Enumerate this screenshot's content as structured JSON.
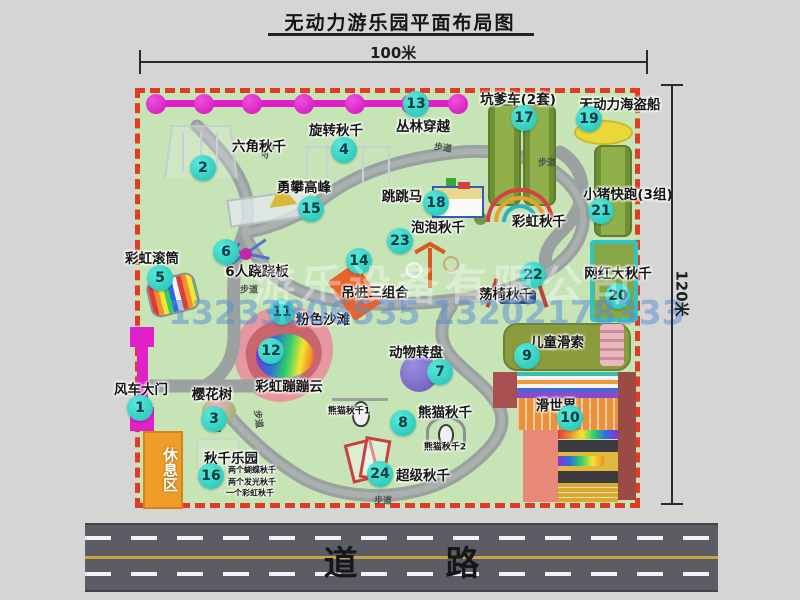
{
  "title": "无动力游乐园平面布局图",
  "dimensions": {
    "top": "100米",
    "right": "120米"
  },
  "road_label": "道 路",
  "rest_area_label": "休息区",
  "walkway_label": "步道",
  "watermark": {
    "company": "游乐设备有限公司",
    "phones": "13233806535 13202178333"
  },
  "colors": {
    "map_green": "#c6e4b5",
    "border_red": "#e23b25",
    "badge_teal": "#1fc2b3",
    "chain_magenta": "#e31ccb",
    "gate_magenta": "#e020c8",
    "rest_orange": "#f09c28",
    "road_gray": "#5c5c64",
    "walkway_gray": "#9ba1a0"
  },
  "attractions": [
    {
      "id": 1,
      "name": "风车大门",
      "badge": [
        140,
        408
      ],
      "label": [
        141,
        388
      ]
    },
    {
      "id": 2,
      "name": "六角秋千",
      "badge": [
        203,
        168
      ],
      "label": [
        259,
        145
      ]
    },
    {
      "id": 3,
      "name": "樱花树",
      "badge": [
        214,
        419
      ],
      "label": [
        212,
        393
      ]
    },
    {
      "id": 4,
      "name": "旋转秋千",
      "badge": [
        344,
        150
      ],
      "label": [
        336,
        129
      ]
    },
    {
      "id": 5,
      "name": "彩虹滚筒",
      "badge": [
        160,
        278
      ],
      "label": [
        152,
        257
      ]
    },
    {
      "id": 6,
      "name": "6人跷跷板",
      "badge": [
        226,
        252
      ],
      "label": [
        257,
        270
      ]
    },
    {
      "id": 7,
      "name": "动物转盘",
      "badge": [
        440,
        372
      ],
      "label": [
        416,
        351
      ]
    },
    {
      "id": 8,
      "name": "熊猫秋千",
      "badge": [
        403,
        423
      ],
      "label": [
        445,
        411
      ]
    },
    {
      "id": 9,
      "name": "儿童滑索",
      "badge": [
        527,
        356
      ],
      "label": [
        557,
        341
      ]
    },
    {
      "id": 10,
      "name": "滑世界",
      "badge": [
        570,
        418
      ],
      "label": [
        556,
        404
      ]
    },
    {
      "id": 11,
      "name": "粉色沙滩",
      "badge": [
        282,
        312
      ],
      "label": [
        323,
        318
      ]
    },
    {
      "id": 12,
      "name": "彩虹蹦蹦云",
      "badge": [
        271,
        351
      ],
      "label": [
        289,
        385
      ]
    },
    {
      "id": 13,
      "name": "丛林穿越",
      "badge": [
        416,
        104
      ],
      "label": [
        423,
        125
      ]
    },
    {
      "id": 14,
      "name": "吊桩三组合",
      "badge": [
        359,
        261
      ],
      "label": [
        375,
        291
      ]
    },
    {
      "id": 15,
      "name": "勇攀高峰",
      "badge": [
        311,
        209
      ],
      "label": [
        304,
        186
      ]
    },
    {
      "id": 16,
      "name": "秋千乐园",
      "badge": [
        211,
        476
      ],
      "label": [
        231,
        457
      ]
    },
    {
      "id": 17,
      "name": "坑爹车(2套)",
      "badge": [
        524,
        118
      ],
      "label": [
        518,
        98
      ]
    },
    {
      "id": 18,
      "name": "跳跳马",
      "badge": [
        436,
        203
      ],
      "label": [
        402,
        195
      ]
    },
    {
      "id": 19,
      "name": "无动力海盗船",
      "badge": [
        589,
        119
      ],
      "label": [
        620,
        103
      ]
    },
    {
      "id": 20,
      "name": "网红大秋千",
      "badge": [
        618,
        296
      ],
      "label": [
        618,
        272
      ]
    },
    {
      "id": 21,
      "name": "小猪快跑(3组)",
      "badge": [
        601,
        211
      ],
      "label": [
        628,
        193
      ]
    },
    {
      "id": 22,
      "name": "荡椅秋千",
      "badge": [
        533,
        275
      ],
      "label": [
        506,
        293
      ]
    },
    {
      "id": 23,
      "name": "泡泡秋千",
      "badge": [
        400,
        241
      ],
      "label": [
        438,
        226
      ]
    },
    {
      "id": 24,
      "name": "超级秋千",
      "badge": [
        380,
        474
      ],
      "label": [
        423,
        474
      ]
    }
  ],
  "extra_labels": [
    {
      "text": "彩虹秋千",
      "x": 539,
      "y": 220,
      "size": "normal"
    },
    {
      "text": "熊猫秋千1",
      "x": 349,
      "y": 410,
      "size": "small"
    },
    {
      "text": "熊猫秋千2",
      "x": 445,
      "y": 446,
      "size": "small"
    },
    {
      "text": "两个蝴蝶秋千",
      "x": 228,
      "y": 470,
      "size": "tiny"
    },
    {
      "text": "两个发光秋千",
      "x": 228,
      "y": 482,
      "size": "tiny"
    },
    {
      "text": "一个彩虹秋千",
      "x": 226,
      "y": 493,
      "size": "tiny"
    }
  ],
  "path_labels": [
    {
      "x": 268,
      "y": 150,
      "rot": -55
    },
    {
      "x": 443,
      "y": 147,
      "rot": 8
    },
    {
      "x": 547,
      "y": 162,
      "rot": 0
    },
    {
      "x": 249,
      "y": 289,
      "rot": 0
    },
    {
      "x": 259,
      "y": 419,
      "rot": 82
    },
    {
      "x": 383,
      "y": 500,
      "rot": 0
    }
  ],
  "chain": {
    "y": 104,
    "xs": [
      156,
      204,
      252,
      304,
      355,
      411,
      458
    ]
  }
}
